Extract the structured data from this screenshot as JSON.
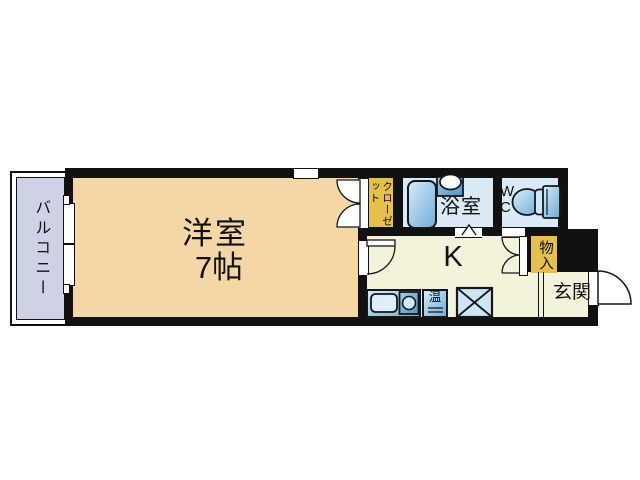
{
  "colors": {
    "wall": "#111111",
    "bedroom_floor": "#f5d7a7",
    "kitchen_floor": "#f3f2da",
    "wet_floor": "#d9e9f5",
    "closet_fill": "#e6c04f",
    "balcony_fill": "#cdd2e5",
    "fixture_light": "#d6edf9",
    "fixture_mid": "#6fabd6",
    "fixture_deep": "#4d92c6",
    "laundry_fill": "#cde6f5"
  },
  "rooms": {
    "balcony": {
      "label": "バルコニー"
    },
    "bedroom": {
      "label": "洋室",
      "size_label": "7帖"
    },
    "closet": {
      "label": "クローゼット"
    },
    "bathroom": {
      "label": "浴室"
    },
    "toilet": {
      "label_line1": "W",
      "label_line2": "C"
    },
    "kitchen": {
      "label": "K"
    },
    "storage": {
      "label": "物入"
    },
    "entrance": {
      "label": "玄関"
    }
  },
  "fixtures": {
    "water_heater": {
      "label": "温"
    }
  }
}
